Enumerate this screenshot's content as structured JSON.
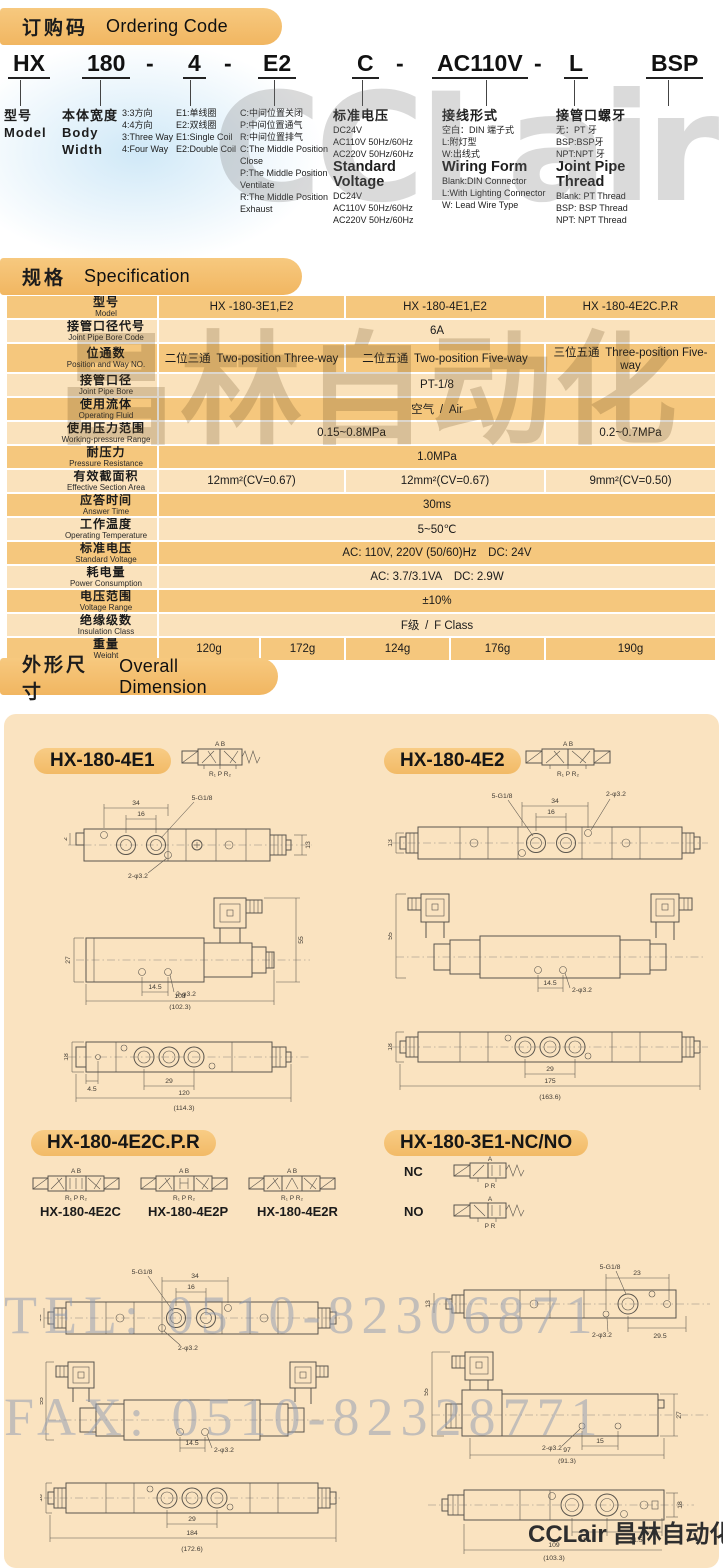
{
  "page": {
    "footer_brand": "CCLair 昌林自动化",
    "watermark_tel": "TEL: 0510-82306871",
    "watermark_fax": "FAX: 0510-82328771",
    "watermark_top": "CCLair",
    "watermark_mid": "昌林自动化"
  },
  "ordering": {
    "title_cn": "订购码",
    "title_en": "Ordering Code",
    "code": [
      "HX",
      "180",
      "-",
      "4",
      "-",
      "E2",
      "C",
      "-",
      "AC110V",
      "-",
      "L",
      "BSP"
    ],
    "columns": [
      [
        "型号",
        "Model"
      ],
      [
        "本体宽度",
        "Body Width"
      ],
      [
        "3:3方向",
        "4:4方向",
        "3:Three Way",
        "4:Four Way"
      ],
      [
        "E1:单线圈",
        "E2:双线圈",
        "E1:Single Coil",
        "E2:Double Coil"
      ],
      [
        "C:中间位置关闭",
        "P:中间位置通气",
        "R:中间位置排气",
        "C:The Middle Position Close",
        "P:The Middle Position Ventilate",
        "R:The Middle Position Exhaust"
      ],
      [
        "标准电压",
        "DC24V",
        "AC110V 50Hz/60Hz",
        "AC220V 50Hz/60Hz",
        "Standard Voltage",
        "DC24V",
        "AC110V 50Hz/60Hz",
        "AC220V 50Hz/60Hz"
      ],
      [
        "接线形式",
        "空白：DIN 端子式",
        "L:附灯型",
        "W:出线式",
        "Wiring Form",
        "Blank:DIN Connector",
        "L:With Lighting Connector",
        "W: Lead Wire Type"
      ],
      [
        "接管口螺牙",
        "无：PT 牙",
        "BSP:BSP牙",
        "NPT:NPT 牙",
        "Joint Pipe Thread",
        "Blank: PT Thread",
        "BSP: BSP Thread",
        "NPT: NPT Thread"
      ]
    ]
  },
  "spec": {
    "title_cn": "规格",
    "title_en": "Specification",
    "rows": [
      {
        "label_cn": "型号",
        "label_en": "Model",
        "cells": [
          "HX -180-3E1,E2",
          "HX -180-4E1,E2",
          "HX -180-4E2C.P.R"
        ]
      },
      {
        "label_cn": "接管口径代号",
        "label_en": "Joint Pipe Bore Code",
        "cells": [
          "6A"
        ]
      },
      {
        "label_cn": "位通数",
        "label_en": "Position and Way NO.",
        "cells": [
          "二位三通 Two-position Three-way",
          "二位五通 Two-position Five-way",
          "三位五通 Three-position Five-way"
        ]
      },
      {
        "label_cn": "接管口径",
        "label_en": "Joint Pipe Bore",
        "cells": [
          "PT-1/8"
        ]
      },
      {
        "label_cn": "使用流体",
        "label_en": "Operating Fluid",
        "cells": [
          "空气 / Air"
        ]
      },
      {
        "label_cn": "使用压力范围",
        "label_en": "Working-pressure Range",
        "cells": [
          "0.15~0.8MPa",
          "0.2~0.7MPa"
        ]
      },
      {
        "label_cn": "耐压力",
        "label_en": "Pressure Resistance",
        "cells": [
          "1.0MPa"
        ]
      },
      {
        "label_cn": "有效截面积",
        "label_en": "Effective  Section  Area",
        "cells": [
          "12mm²(CV=0.67)",
          "12mm²(CV=0.67)",
          "9mm²(CV=0.50)"
        ]
      },
      {
        "label_cn": "应答时间",
        "label_en": "Answer Time",
        "cells": [
          "30ms"
        ]
      },
      {
        "label_cn": "工作温度",
        "label_en": "Operating Temperature",
        "cells": [
          "5~50℃"
        ]
      },
      {
        "label_cn": "标准电压",
        "label_en": "Standard Voltage",
        "cells": [
          "AC: 110V, 220V (50/60)Hz DC: 24V"
        ]
      },
      {
        "label_cn": "耗电量",
        "label_en": "Power Consumption",
        "cells": [
          "AC: 3.7/3.1VA DC: 2.9W"
        ]
      },
      {
        "label_cn": "电压范围",
        "label_en": "Voltage Range",
        "cells": [
          "±10%"
        ]
      },
      {
        "label_cn": "绝缘级数",
        "label_en": "Insulation Class",
        "cells": [
          "F级 / F Class"
        ]
      },
      {
        "label_cn": "重量",
        "label_en": "Weight",
        "cells": [
          "120g",
          "172g",
          "124g",
          "176g",
          "190g"
        ]
      }
    ]
  },
  "dimension": {
    "title_cn": "外形尺寸",
    "title_en": "Overall Dimension",
    "labels": {
      "e1": "HX-180-4E1",
      "e2": "HX-180-4E2",
      "cpr": "HX-180-4E2C.P.R",
      "cpr_variants": [
        "HX-180-4E2C",
        "HX-180-4E2P",
        "HX-180-4E2R"
      ],
      "ncno": "HX-180-3E1-NC/NO",
      "nc": "NC",
      "no": "NO"
    },
    "sym": {
      "ab": "A  B",
      "rpr": "R₁ P R₂",
      "a": "A",
      "pr": "P R"
    },
    "dims": {
      "e1_top": [
        "34",
        "16",
        "5-G1/8",
        "2-φ3.2",
        "13",
        "2"
      ],
      "e1_front": [
        "27",
        "55",
        "14.5",
        "2-φ3.2",
        "108",
        "(102.3)"
      ],
      "e1_bottom": [
        "18",
        "4.5",
        "29",
        "120",
        "(114.3)"
      ],
      "e2_top": [
        "34",
        "16",
        "5-G1/8",
        "2-φ3.2",
        "13"
      ],
      "e2_front": [
        "55",
        "14.5",
        "2-φ3.2"
      ],
      "e2_bottom": [
        "18",
        "29",
        "175",
        "(163.6)"
      ],
      "cpr_top": [
        "34",
        "16",
        "5-G1/8",
        "2-φ3.2",
        "13"
      ],
      "cpr_front": [
        "55",
        "14.5",
        "2-φ3.2"
      ],
      "cpr_bottom": [
        "18",
        "29",
        "184",
        "(172.6)"
      ],
      "ncno_top": [
        "5-G1/8",
        "23",
        "13",
        "29.5",
        "2-φ3.2"
      ],
      "ncno_front": [
        "55",
        "27",
        "2-φ3.2",
        "15",
        "97",
        "(91.3)"
      ],
      "ncno_bottom": [
        "18",
        "14.5",
        "21.5",
        "109",
        "(103.3)"
      ]
    }
  }
}
